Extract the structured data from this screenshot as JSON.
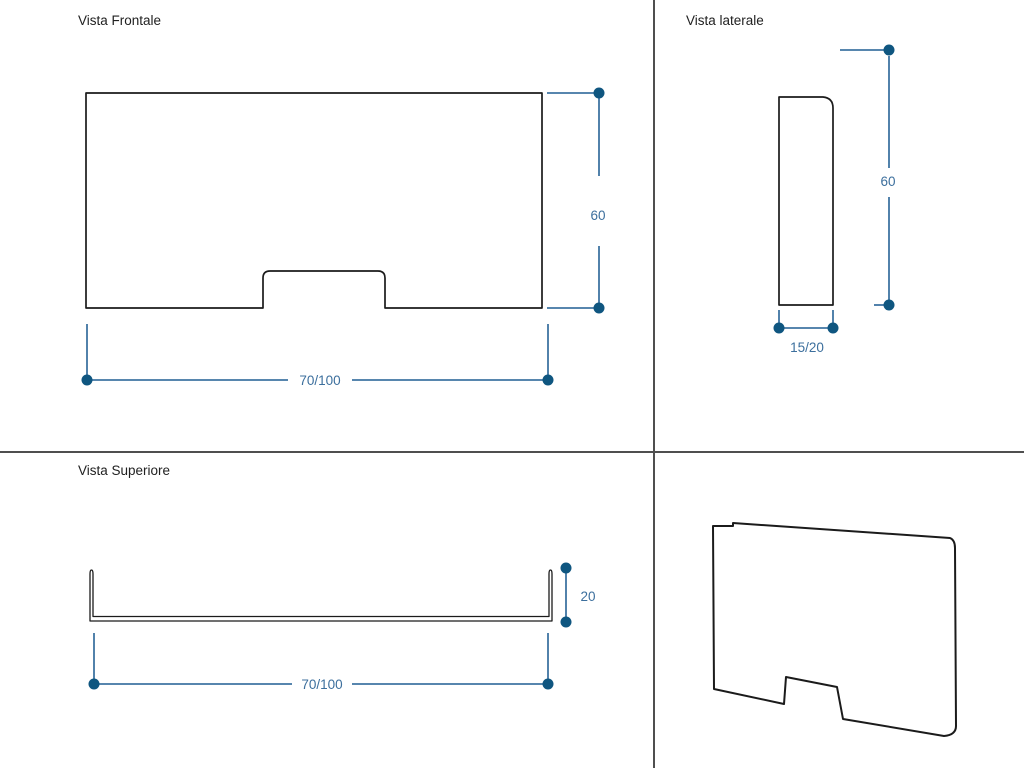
{
  "page": {
    "background": "#ffffff"
  },
  "colors": {
    "page_bg": "#ffffff",
    "outline": "#1b1b1b",
    "divider": "#4f4f4f",
    "dim_line": "#3f74a2",
    "dim_dot": "#0f5680",
    "dim_text": "#3c6f9d",
    "title": "#212121"
  },
  "views": {
    "front": {
      "title": "Vista Frontale",
      "height": "60",
      "width": "70/100"
    },
    "side": {
      "title": "Vista laterale",
      "height": "60",
      "thickness": "15/20"
    },
    "top": {
      "title": "Vista Superiore",
      "depth": "20",
      "width": "70/100"
    }
  }
}
